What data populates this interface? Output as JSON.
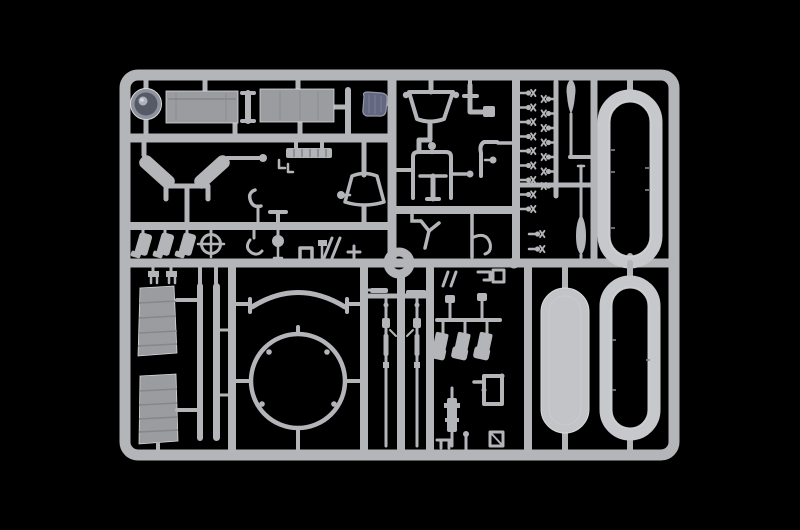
{
  "meta": {
    "title": "Plastic model kit sprue on black background",
    "subject": "Injection-moulded light grey parts tree (sprue) of a scale model kit, product photograph",
    "background_note": "uniform black studio background, no visible text"
  },
  "colors": {
    "background": "#000000",
    "plastic": "#b3b5b9",
    "plastic_light": "#d8dadd",
    "plastic_shadow": "#85878b",
    "panel": "#9a9ca0",
    "ring": "#c6c8cb",
    "float_fill": "#c2c4c7",
    "wheel_rim": "#8e929c",
    "wheel_dark": "#565a66",
    "hub": "#aeb2ba",
    "blue_part": "#636780",
    "blue_part_line": "#9397a7",
    "blue_streak": "#7d8196"
  },
  "parts_inventory": [
    {
      "name": "wheel-drum",
      "count": 1,
      "note": "dark round drum with hub, top left"
    },
    {
      "name": "rectangular-panel",
      "count": 2,
      "note": "flat hull plates, top row"
    },
    {
      "name": "blue-tarp-part",
      "count": 1,
      "note": "small dark blue-grey moulding"
    },
    {
      "name": "v-brace-arms",
      "count": 1,
      "note": "two angled arms with centre bracket"
    },
    {
      "name": "rack-ladder",
      "count": 1
    },
    {
      "name": "funnel-shade",
      "count": 1
    },
    {
      "name": "open-bucket",
      "count": 1
    },
    {
      "name": "seat-frame",
      "count": 1
    },
    {
      "name": "boot-flaps",
      "count": 3
    },
    {
      "name": "crosshair-wheel",
      "count": 1
    },
    {
      "name": "small-bolt-valves",
      "count": 18,
      "note": "double ladder column"
    },
    {
      "name": "teardrop-paddle",
      "count": 2
    },
    {
      "name": "oval-track-ring",
      "count": 2,
      "note": "large rounded rings, right side"
    },
    {
      "name": "pontoon-float-half",
      "count": 1,
      "note": "solid pill shape, lower right"
    },
    {
      "name": "louvered-panel",
      "count": 2,
      "note": "slatted engine grilles, lower left"
    },
    {
      "name": "leaf-spring-strip",
      "count": 2
    },
    {
      "name": "turret-ring-circle",
      "count": 1,
      "note": "large thin circle, lower centre"
    },
    {
      "name": "fender-arc",
      "count": 1
    },
    {
      "name": "rifle-rod",
      "count": 2,
      "note": "long thin detailed rods"
    },
    {
      "name": "bucket-seat",
      "count": 3
    },
    {
      "name": "square-bracket",
      "count": 1
    },
    {
      "name": "cylinder-pump",
      "count": 1
    }
  ]
}
